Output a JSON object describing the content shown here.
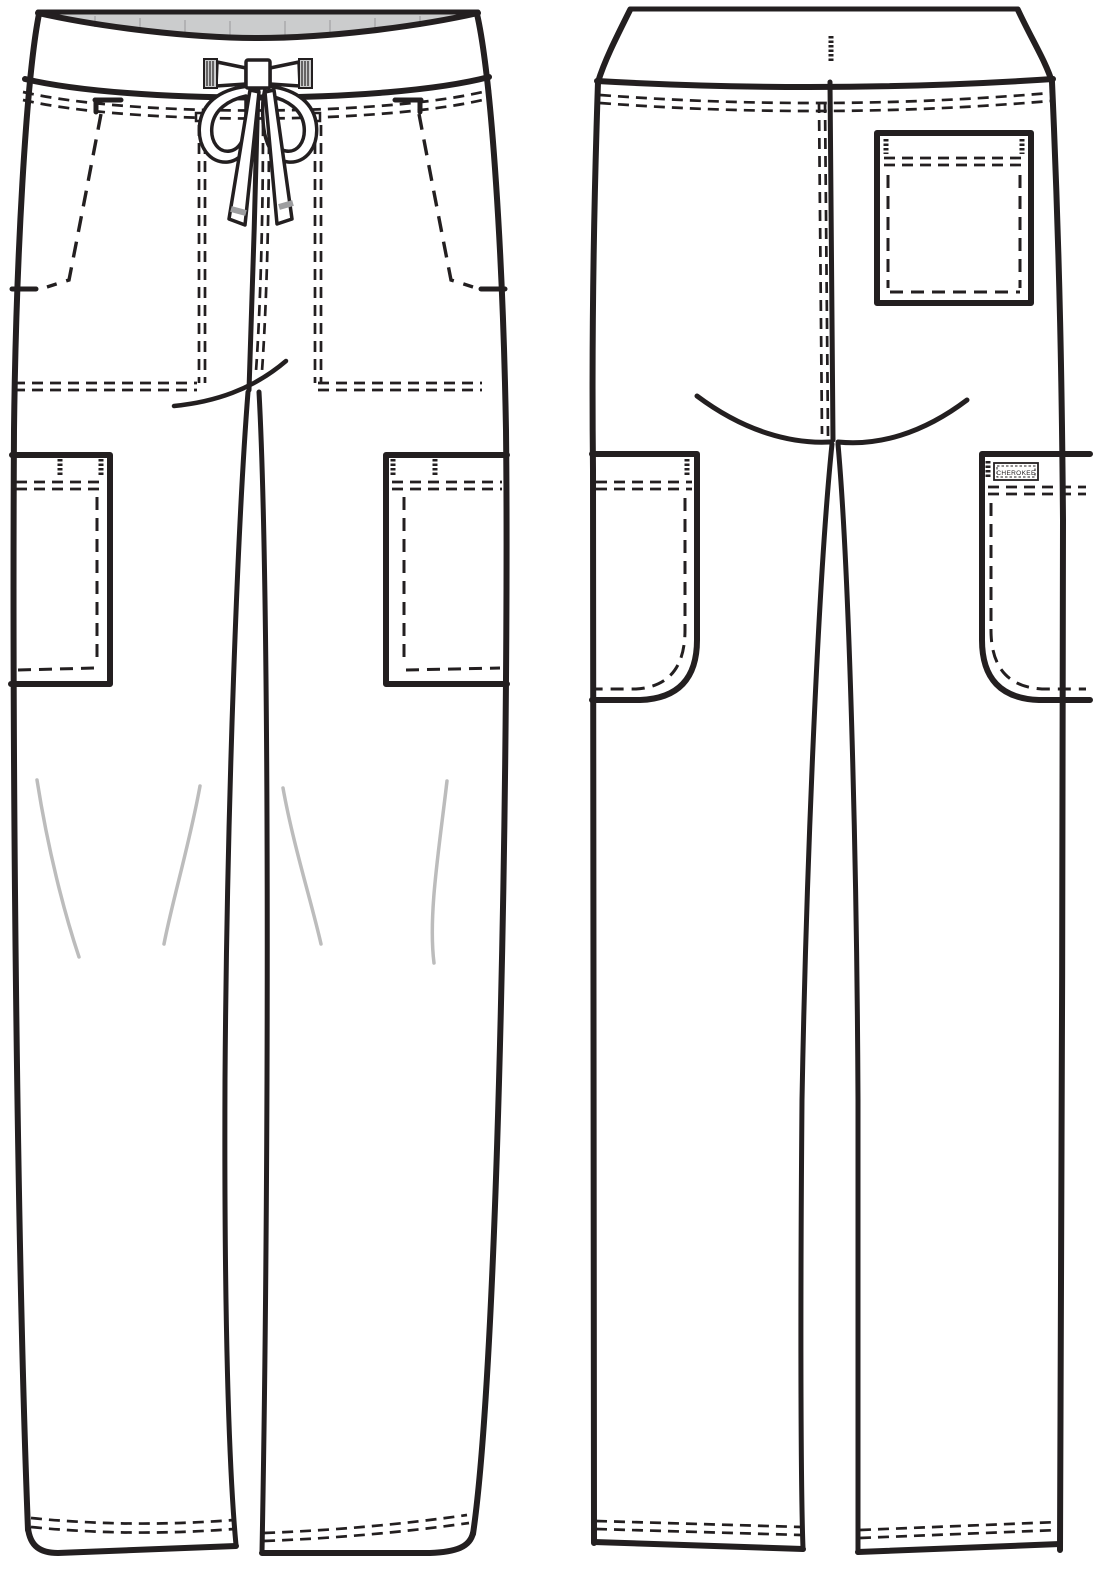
{
  "brand_label": "CHEROKEE",
  "colors": {
    "line": "#231f20",
    "fill": "#ffffff",
    "background": "#ffffff",
    "waistband_inner": "#cbcccd",
    "waistband_hatch": "#a7a8aa",
    "crease": "#bcbcbc",
    "aglet": "#9d9ea0"
  }
}
